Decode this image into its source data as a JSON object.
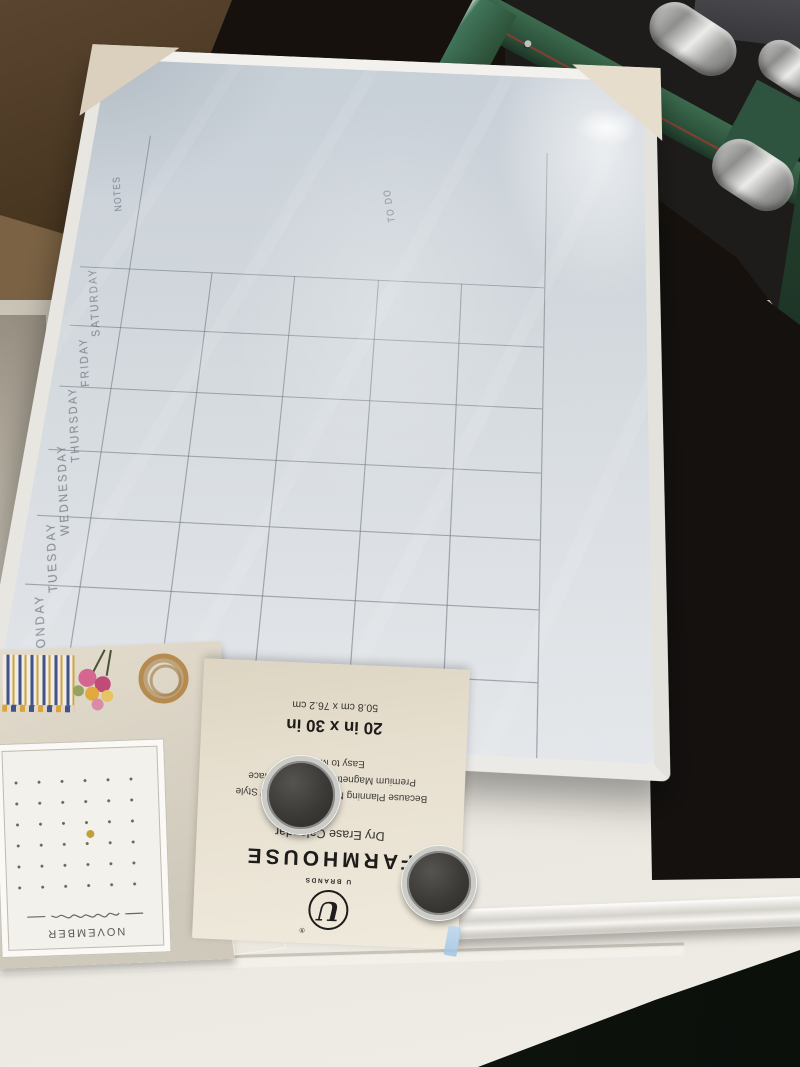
{
  "board": {
    "corner_label": "NOTES",
    "todo_label": "TO DO",
    "rows": [
      "SATURDAY",
      "FRIDAY",
      "THURSDAY",
      "WEDNESDAY",
      "TUESDAY",
      "MONDAY",
      "SUNDAY"
    ],
    "grid": {
      "week_columns": 5,
      "day_rows": 7
    },
    "colors": {
      "surface": "#d3d9de",
      "line": "#68707a",
      "frame": "#f2f1ee"
    }
  },
  "packaging_card": {
    "brand_small": "U BRANDS",
    "logo_letter": "U",
    "registered_mark": "®",
    "title": "FARMHOUSE",
    "subtitle": "Dry Erase Calendar",
    "tagline": "Because Planning Never Goes Out of Style",
    "feature_magnetic": "Premium Magnetic Dry Erase Surface",
    "feature_mount": "Easy to Mount",
    "size_inches": "20 in x 30 in",
    "size_cm": "50.8 cm x 76.2 cm"
  },
  "sleeve_photo": {
    "mini_calendar_title": "NOVEMBER"
  },
  "magnets": {
    "count": 2
  }
}
